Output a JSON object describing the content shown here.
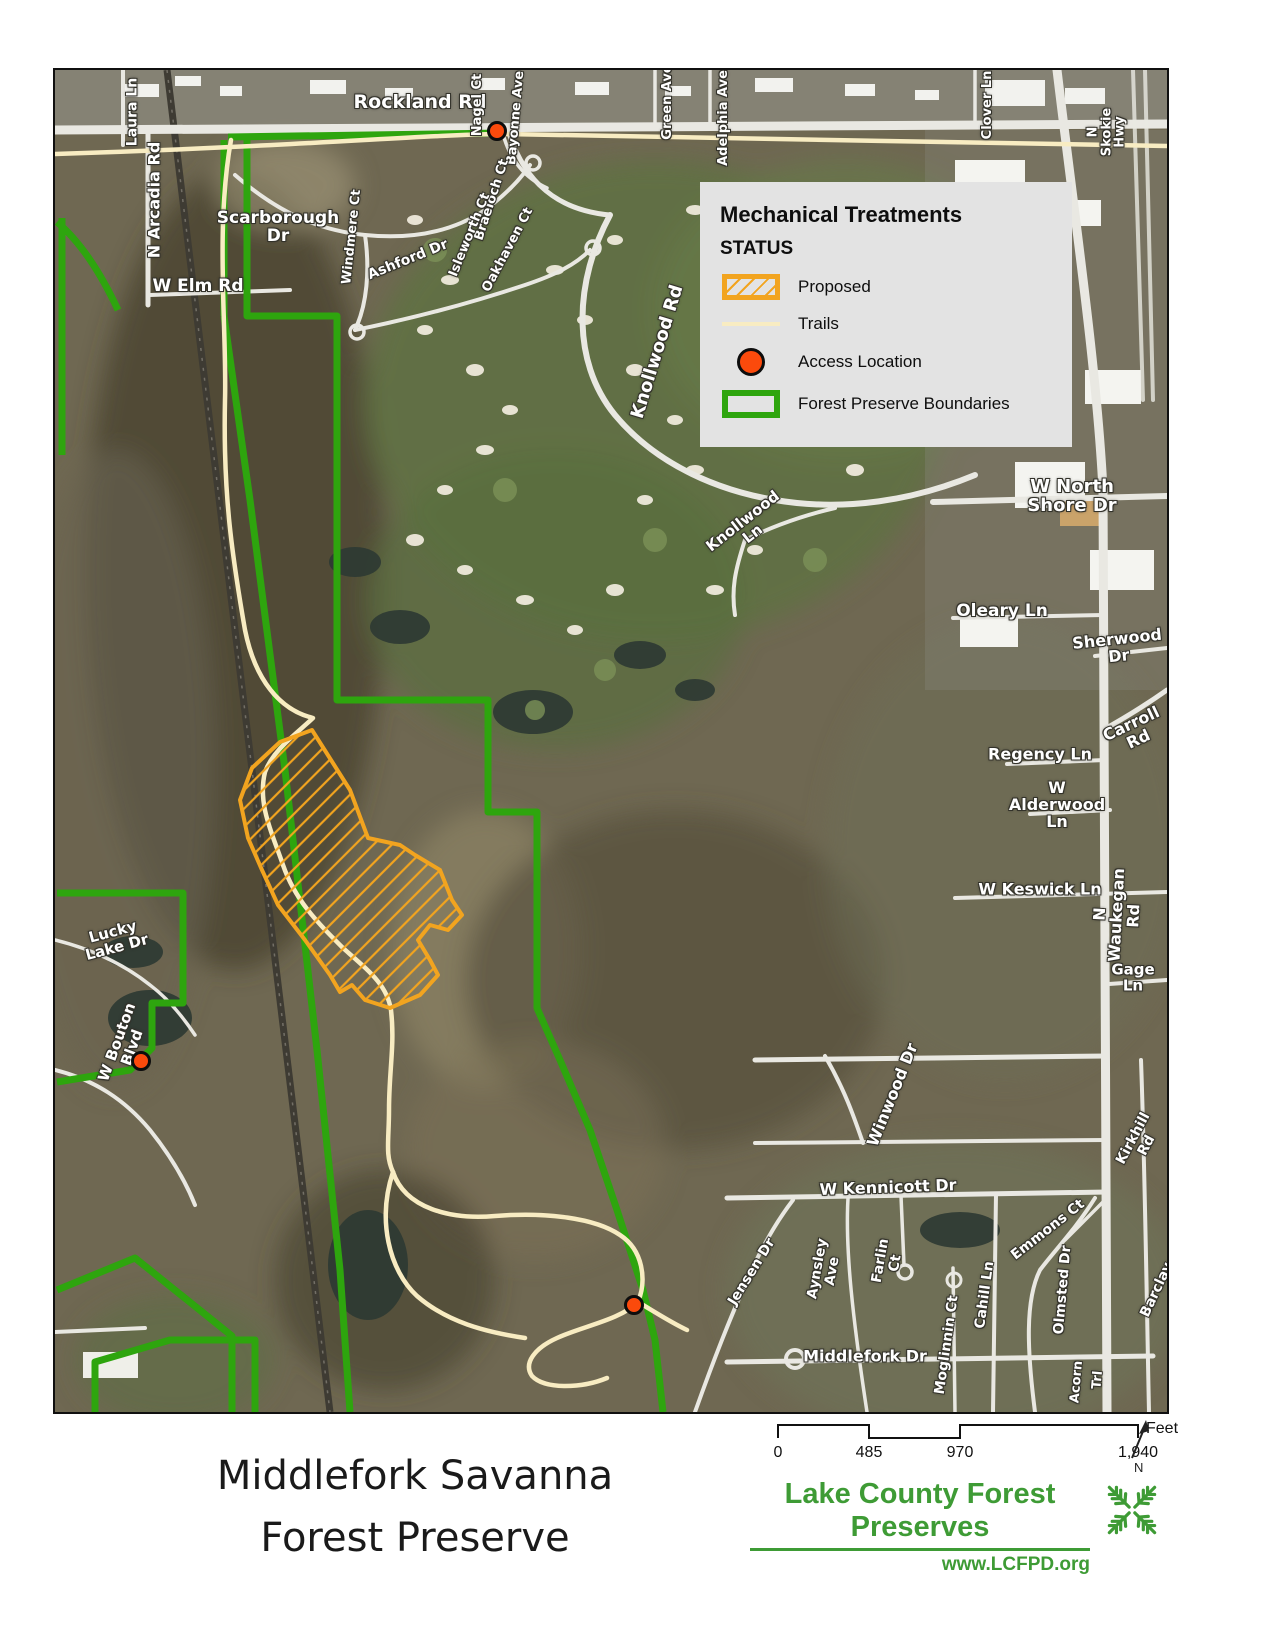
{
  "page": {
    "title_line1": "Middlefork Savanna",
    "title_line2": "Forest Preserve"
  },
  "legend": {
    "title": "Mechanical Treatments",
    "subtitle": "STATUS",
    "items": [
      {
        "label": "Proposed",
        "swatch": "orange-hatched-rect"
      },
      {
        "label": "Trails",
        "swatch": "pale-yellow-line"
      },
      {
        "label": "Access Location",
        "swatch": "orange-dot"
      },
      {
        "label": "Forest Preserve Boundaries",
        "swatch": "green-outline-rect"
      }
    ]
  },
  "scale_bar": {
    "unit": "Feet",
    "ticks": [
      {
        "label": "0",
        "x": 8
      },
      {
        "label": "485",
        "x": 99
      },
      {
        "label": "970",
        "x": 190
      },
      {
        "label": "1,940",
        "x": 368
      }
    ]
  },
  "north_arrow": {
    "label": "N"
  },
  "logo": {
    "name": "Lake County Forest Preserves",
    "url": "www.LCFPD.org"
  },
  "colors": {
    "boundary_green": "#2ea50e",
    "proposed_orange": "#f2a41f",
    "trail_cream": "#f8ecc2",
    "access_orange": "#fb4a0c",
    "legend_bg": "#e3e3e3",
    "logo_green": "#3e9b35"
  },
  "access_points": [
    {
      "x": 442,
      "y": 61
    },
    {
      "x": 86,
      "y": 991
    },
    {
      "x": 579,
      "y": 1235
    }
  ],
  "map_labels": [
    {
      "text": "Laura Ln",
      "x": 78,
      "y": 42,
      "r": -90,
      "s": 14
    },
    {
      "text": "Rockland Rd",
      "x": 365,
      "y": 33,
      "r": 0,
      "s": 19
    },
    {
      "text": "Nagel Ct",
      "x": 423,
      "y": 35,
      "r": -90,
      "s": 13
    },
    {
      "text": "Bayonne Ave",
      "x": 461,
      "y": 48,
      "r": -85,
      "s": 13
    },
    {
      "text": "Green Ave",
      "x": 613,
      "y": 32,
      "r": -90,
      "s": 13
    },
    {
      "text": "Adelphia Ave",
      "x": 669,
      "y": 48,
      "r": -90,
      "s": 13
    },
    {
      "text": "Clover Ln",
      "x": 933,
      "y": 35,
      "r": -90,
      "s": 13
    },
    {
      "text": "N Skokie Hwy",
      "x": 1052,
      "y": 62,
      "r": -90,
      "s": 13
    },
    {
      "text": "N Arcadia Rd",
      "x": 100,
      "y": 130,
      "r": -90,
      "s": 16
    },
    {
      "text": "Scarborough\nDr",
      "x": 223,
      "y": 158,
      "r": 0,
      "s": 17
    },
    {
      "text": "W Elm Rd",
      "x": 143,
      "y": 217,
      "r": 0,
      "s": 17
    },
    {
      "text": "Windmere Ct",
      "x": 297,
      "y": 167,
      "r": -84,
      "s": 13
    },
    {
      "text": "Ashford Dr",
      "x": 353,
      "y": 190,
      "r": -22,
      "s": 14
    },
    {
      "text": "Braeloch Ct",
      "x": 437,
      "y": 130,
      "r": -72,
      "s": 13
    },
    {
      "text": "Isleworth Ct",
      "x": 415,
      "y": 165,
      "r": -68,
      "s": 13
    },
    {
      "text": "Oakhaven Ct",
      "x": 453,
      "y": 180,
      "r": -62,
      "s": 13
    },
    {
      "text": "Knollwood Rd",
      "x": 603,
      "y": 282,
      "r": -73,
      "s": 18
    },
    {
      "text": "Knollwood\nLn",
      "x": 693,
      "y": 458,
      "r": -38,
      "s": 15
    },
    {
      "text": "W North Shore Dr",
      "x": 1017,
      "y": 427,
      "r": 0,
      "s": 18
    },
    {
      "text": "Oleary Ln",
      "x": 947,
      "y": 542,
      "r": 0,
      "s": 17
    },
    {
      "text": "Sherwood Dr",
      "x": 1063,
      "y": 578,
      "r": -6,
      "s": 16
    },
    {
      "text": "Carroll\nRd",
      "x": 1080,
      "y": 662,
      "r": -25,
      "s": 16
    },
    {
      "text": "Regency Ln",
      "x": 985,
      "y": 685,
      "r": 0,
      "s": 16
    },
    {
      "text": "W Alderwood Ln",
      "x": 1002,
      "y": 735,
      "r": 0,
      "s": 16
    },
    {
      "text": "W Keswick Ln",
      "x": 985,
      "y": 820,
      "r": 0,
      "s": 16
    },
    {
      "text": "N Waukegan Rd",
      "x": 1062,
      "y": 845,
      "r": -87,
      "s": 16
    },
    {
      "text": "Gage Ln",
      "x": 1078,
      "y": 908,
      "r": 0,
      "s": 15
    },
    {
      "text": "Winwood Dr",
      "x": 838,
      "y": 1025,
      "r": -68,
      "s": 16
    },
    {
      "text": "Kirkhill\nRd",
      "x": 1085,
      "y": 1072,
      "r": -62,
      "s": 14
    },
    {
      "text": "W Kennicott Dr",
      "x": 833,
      "y": 1118,
      "r": -2,
      "s": 16
    },
    {
      "text": "Jensen Dr",
      "x": 697,
      "y": 1202,
      "r": -58,
      "s": 14
    },
    {
      "text": "Aynsley\nAve",
      "x": 770,
      "y": 1200,
      "r": -80,
      "s": 14
    },
    {
      "text": "Farlin\nCt",
      "x": 833,
      "y": 1192,
      "r": -80,
      "s": 14
    },
    {
      "text": "Cahill Ln",
      "x": 930,
      "y": 1225,
      "r": -82,
      "s": 14
    },
    {
      "text": "Emmons Ct",
      "x": 993,
      "y": 1160,
      "r": -38,
      "s": 14
    },
    {
      "text": "Olmsted Dr",
      "x": 1008,
      "y": 1220,
      "r": -85,
      "s": 14
    },
    {
      "text": "Barclay",
      "x": 1102,
      "y": 1220,
      "r": -65,
      "s": 14
    },
    {
      "text": "Middlefork Dr",
      "x": 810,
      "y": 1287,
      "r": 0,
      "s": 16
    },
    {
      "text": "Moglinnin Ct",
      "x": 892,
      "y": 1275,
      "r": -82,
      "s": 14
    },
    {
      "text": "Acorn",
      "x": 1022,
      "y": 1312,
      "r": -85,
      "s": 13
    },
    {
      "text": "Trl",
      "x": 1043,
      "y": 1310,
      "r": -85,
      "s": 13
    },
    {
      "text": "Lucky\nLake Dr",
      "x": 60,
      "y": 870,
      "r": -15,
      "s": 15
    },
    {
      "text": "W Bouton\nBlvd",
      "x": 70,
      "y": 975,
      "r": -70,
      "s": 15
    }
  ]
}
